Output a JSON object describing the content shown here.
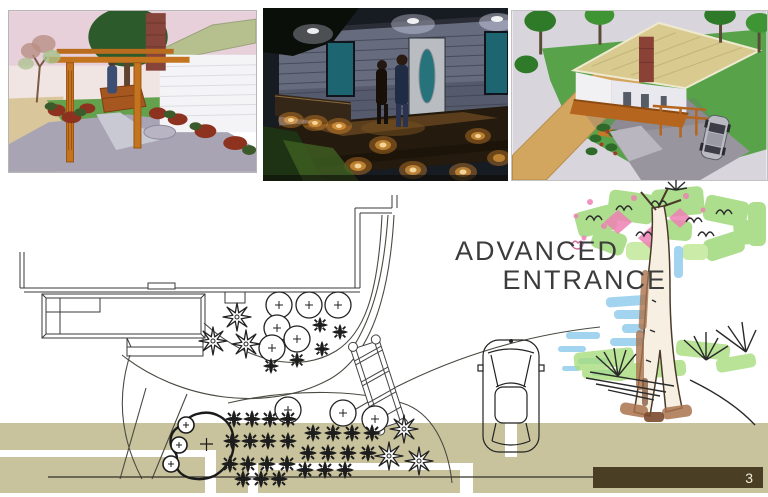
{
  "slide": {
    "kind": "landscape-design-presentation-page",
    "title": {
      "line1": "ADVANCED",
      "line2": "ENTRANCE"
    },
    "page_number": "3",
    "renders": [
      {
        "name": "pergola-walkway-daytime-render"
      },
      {
        "name": "entry-deck-night-lighting-render"
      },
      {
        "name": "aerial-house-site-render"
      }
    ],
    "plan": {
      "features": [
        "house-outline",
        "entry-deck-with-steps",
        "curved-planting-beds",
        "shrub-symbols",
        "groundcover-grid",
        "boulder-grouping",
        "arbor-trellis",
        "parked-car",
        "street-walkway-band"
      ]
    },
    "colors": {
      "walkway_band_tan": "#c8c39c",
      "footer_bar_brown": "#4a3f24",
      "title_text": "#3c3c3c",
      "page_number_text": "#f2ecd8"
    }
  }
}
